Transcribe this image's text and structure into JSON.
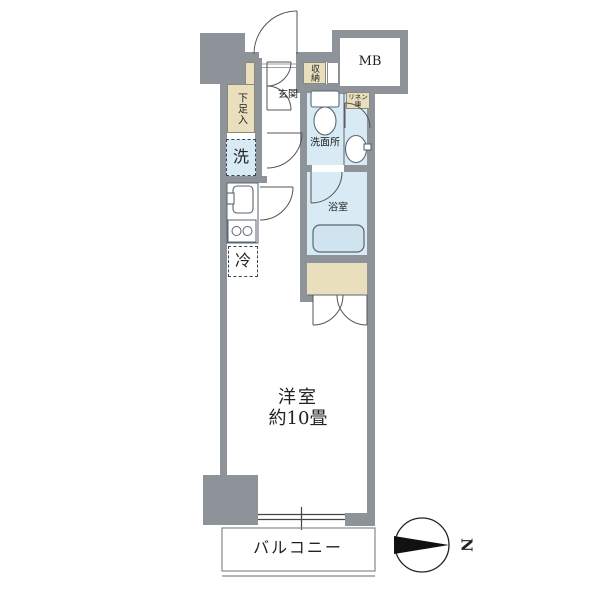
{
  "title": "apartment-floor-plan",
  "labels": {
    "entrance": "玄関",
    "shoe_box": "下足入",
    "storage": "収納",
    "meter_box": "MB",
    "linen_line1": "リネン",
    "linen_line2": "庫",
    "washroom": "洗面所",
    "bathroom": "浴室",
    "washer": "洗",
    "fridge": "冷",
    "main_room_line1": "洋室",
    "main_room_line2": "約10畳",
    "balcony": "バルコニー",
    "compass_north": "N"
  },
  "colors": {
    "wall": "#8e939a",
    "storage-fill": "#e9dfbc",
    "wet-fill": "#d8eaf3",
    "tub-fill": "#cfe4ee",
    "line": "#5a6670",
    "door-line": "#555555",
    "text": "#222222",
    "balcony-line": "#888888"
  }
}
